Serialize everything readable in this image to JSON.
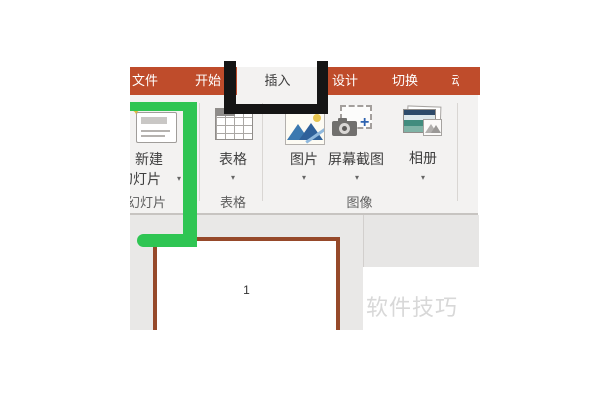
{
  "window": {
    "description": "PowerPoint ribbon screenshot, Chinese UI, Insert tab active"
  },
  "menu_bar": {
    "tabs": [
      {
        "label": "文件"
      },
      {
        "label": "开始"
      },
      {
        "label": "插入",
        "active": true
      },
      {
        "label": "设计"
      },
      {
        "label": "切换"
      },
      {
        "label": "动",
        "note": "partially visible at crop edge"
      }
    ]
  },
  "ribbon": {
    "dropdown_arrow": "▾",
    "sparkle_glyph": "✦",
    "plus_glyph": "+",
    "new_slide": {
      "line1": "新建",
      "line2": "幻灯片"
    },
    "buttons": {
      "table": {
        "label": "表格"
      },
      "picture": {
        "label": "图片"
      },
      "screenshot": {
        "label": "屏幕截图"
      },
      "album": {
        "label": "相册"
      }
    },
    "groups": {
      "slides": {
        "label": "幻灯片"
      },
      "table": {
        "label": "表格"
      },
      "image": {
        "label": "图像"
      }
    }
  },
  "canvas": {
    "slide_number": "1"
  },
  "watermark": {
    "text": "软件技巧"
  },
  "colors": {
    "ribbon_red": "#bf4c2b",
    "ribbon_bg": "#f3f2f1",
    "annotation_green": "#2fc553",
    "annotation_black": "#151515",
    "slide_border_brown": "#96492a"
  }
}
